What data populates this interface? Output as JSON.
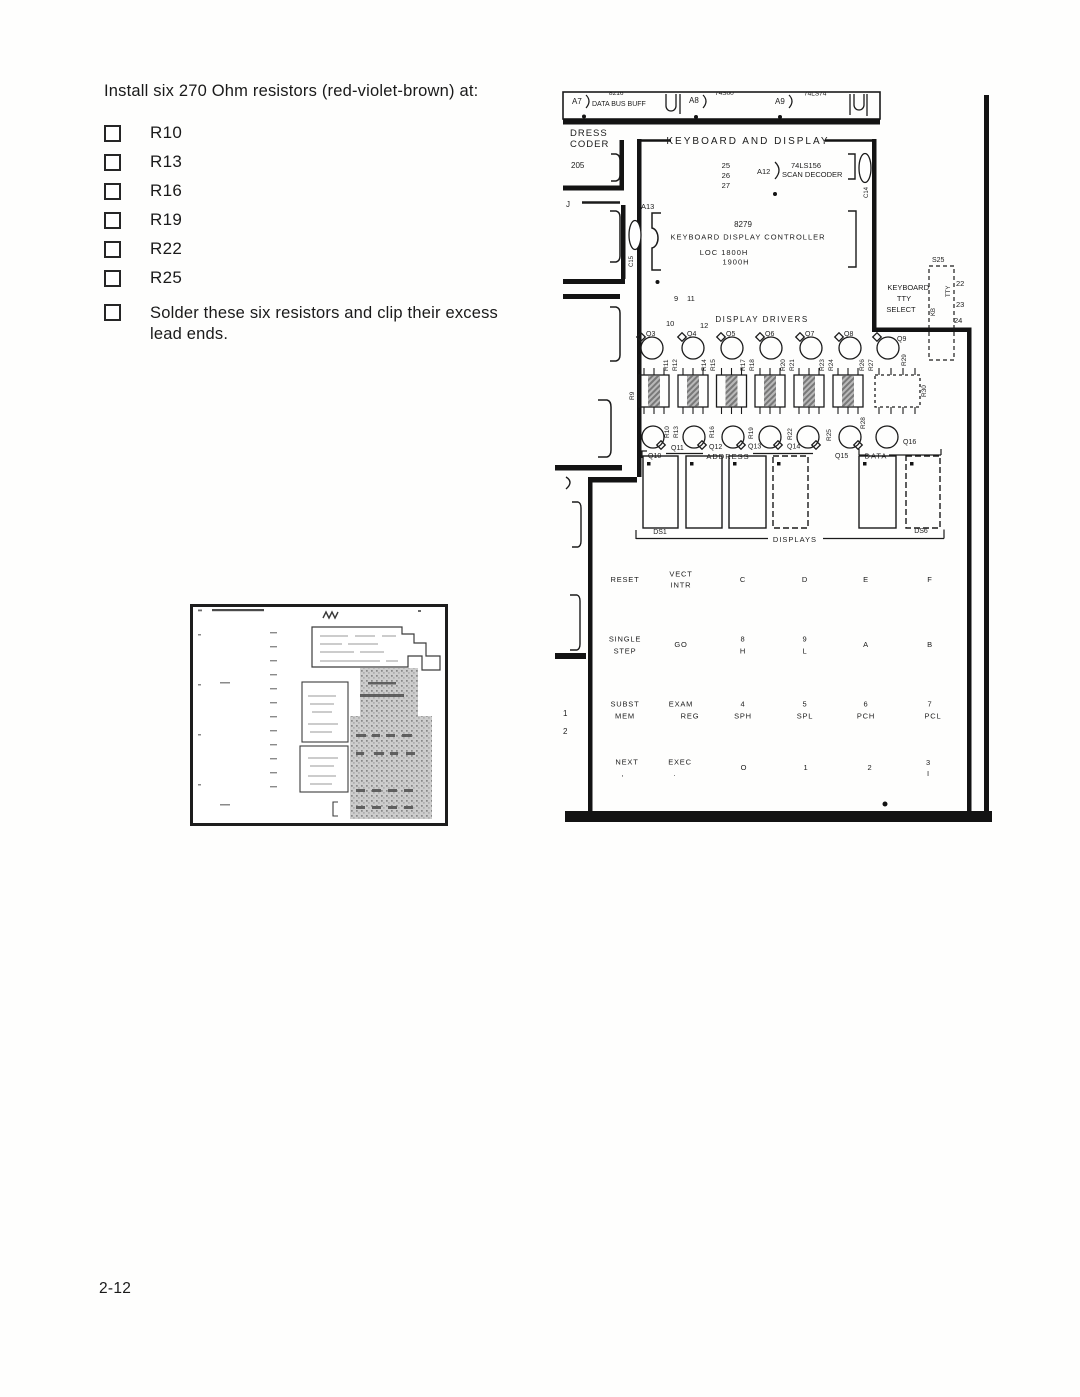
{
  "page": {
    "number": "2-12"
  },
  "instructions": {
    "intro": "Install six 270 Ohm resistors (red-violet-brown) at:",
    "items": [
      "R10",
      "R13",
      "R16",
      "R19",
      "R22",
      "R25"
    ],
    "solder_line1": "Solder these six resistors and clip their excess",
    "solder_line2": "lead ends."
  },
  "diagram": {
    "strip": {
      "a7": "A7",
      "a7_chip": "8216",
      "a7_name": "DATA BUS BUFF",
      "a8": "A8",
      "a8_chip": "74S00",
      "a9": "A9",
      "a9_chip": "74LS74"
    },
    "decoder": {
      "line1": "DRESS",
      "line2": "CODER",
      "chip": "205",
      "j": "J"
    },
    "title": "KEYBOARD AND DISPLAY",
    "scan": {
      "p25": "25",
      "p26": "26",
      "p27": "27",
      "ref": "A12",
      "chip": "74LS156",
      "name": "SCAN DECODER",
      "cap": "C14"
    },
    "ctrl": {
      "a13": "A13",
      "cap": "C15",
      "chip": "8279",
      "name": "KEYBOARD DISPLAY CONTROLLER",
      "loc1": "LOC 1800H",
      "loc2": "1900H",
      "p9": "9",
      "p11": "11",
      "p10": "10",
      "p12": "12"
    },
    "drivers": {
      "title": "DISPLAY DRIVERS",
      "q_top": [
        "Q3",
        "Q4",
        "Q5",
        "Q6",
        "Q7",
        "Q8",
        "Q9"
      ],
      "r_top": [
        "R11",
        "R12",
        "R14",
        "R15",
        "R17",
        "R18",
        "R20",
        "R21",
        "R23",
        "R24",
        "R26",
        "R27",
        "R29"
      ],
      "r9": "R9",
      "r30": "R30",
      "r_bottom": [
        "R10",
        "R13",
        "R16",
        "R19",
        "R22",
        "R25",
        "R28"
      ],
      "q_bottom": [
        "Q10",
        "Q11",
        "Q12",
        "Q13",
        "Q14",
        "Q15",
        "Q16"
      ]
    },
    "displays": {
      "address": "ADDRESS",
      "data": "DATA",
      "ds1": "DS1",
      "ds6": "DS6",
      "label": "DISPLAYS"
    },
    "tty": {
      "l1": "KEYBOARD",
      "l2": "TTY",
      "l3": "SELECT",
      "s25": "S25",
      "tty": "TTY",
      "kb": "KB",
      "p22": "22",
      "p23": "23",
      "p24": "24"
    },
    "side": {
      "p1": "1",
      "p2": "2"
    },
    "keypad": {
      "rows": [
        [
          {
            "t": "RESET"
          },
          {
            "t": "VECT",
            "s": "INTR"
          },
          {
            "t": "C"
          },
          {
            "t": "D"
          },
          {
            "t": "E"
          },
          {
            "t": "F"
          }
        ],
        [
          {
            "t": "SINGLE",
            "s": "STEP"
          },
          {
            "t": "GO"
          },
          {
            "t": "8",
            "s": "H"
          },
          {
            "t": "9",
            "s": "L"
          },
          {
            "t": "A"
          },
          {
            "t": "B"
          }
        ],
        [
          {
            "t": "SUBST",
            "s": "MEM"
          },
          {
            "t": "EXAM",
            "s": "REG"
          },
          {
            "t": "4",
            "s": "SPH"
          },
          {
            "t": "5",
            "s": "SPL"
          },
          {
            "t": "6",
            "s": "PCH"
          },
          {
            "t": "7",
            "s": "PCL"
          }
        ],
        [
          {
            "t": "NEXT",
            "s": ","
          },
          {
            "t": "EXEC",
            "s": "."
          },
          {
            "t": "O"
          },
          {
            "t": "1"
          },
          {
            "t": "2"
          },
          {
            "t": "3",
            "s": "I"
          }
        ]
      ]
    }
  }
}
